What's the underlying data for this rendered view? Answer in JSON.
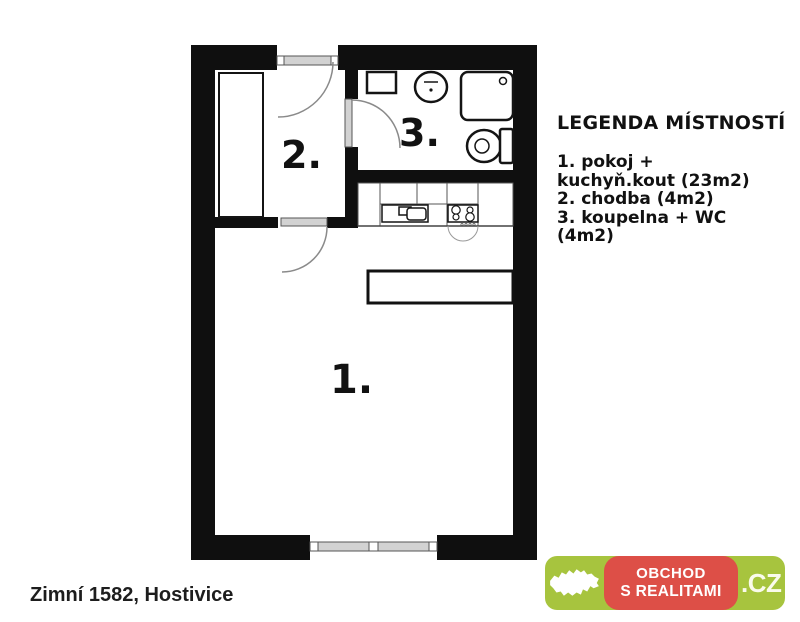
{
  "colors": {
    "wall": "#0f0f0f",
    "fixture_line": "#141414",
    "door_fill": "#d2d2d2",
    "arc": "#8a8a8a",
    "logo_green": "#a7c43e",
    "logo_red": "#dd4f47",
    "logo_text": "#ffffff",
    "logo_tld": "#fafbec"
  },
  "plan": {
    "rooms": [
      {
        "label": "1."
      },
      {
        "label": "2."
      },
      {
        "label": "3."
      }
    ]
  },
  "legend": {
    "title": "LEGENDA MÍSTNOSTÍ",
    "lines": [
      "1. pokoj +",
      "kuchyň.kout (23m2)",
      "2. chodba (4m2)",
      "3. koupelna + WC",
      "(4m2)"
    ]
  },
  "address": "Zimní 1582, Hostivice",
  "logo": {
    "line1": "OBCHOD",
    "line2": "S REALITAMI",
    "tld": ".CZ"
  }
}
